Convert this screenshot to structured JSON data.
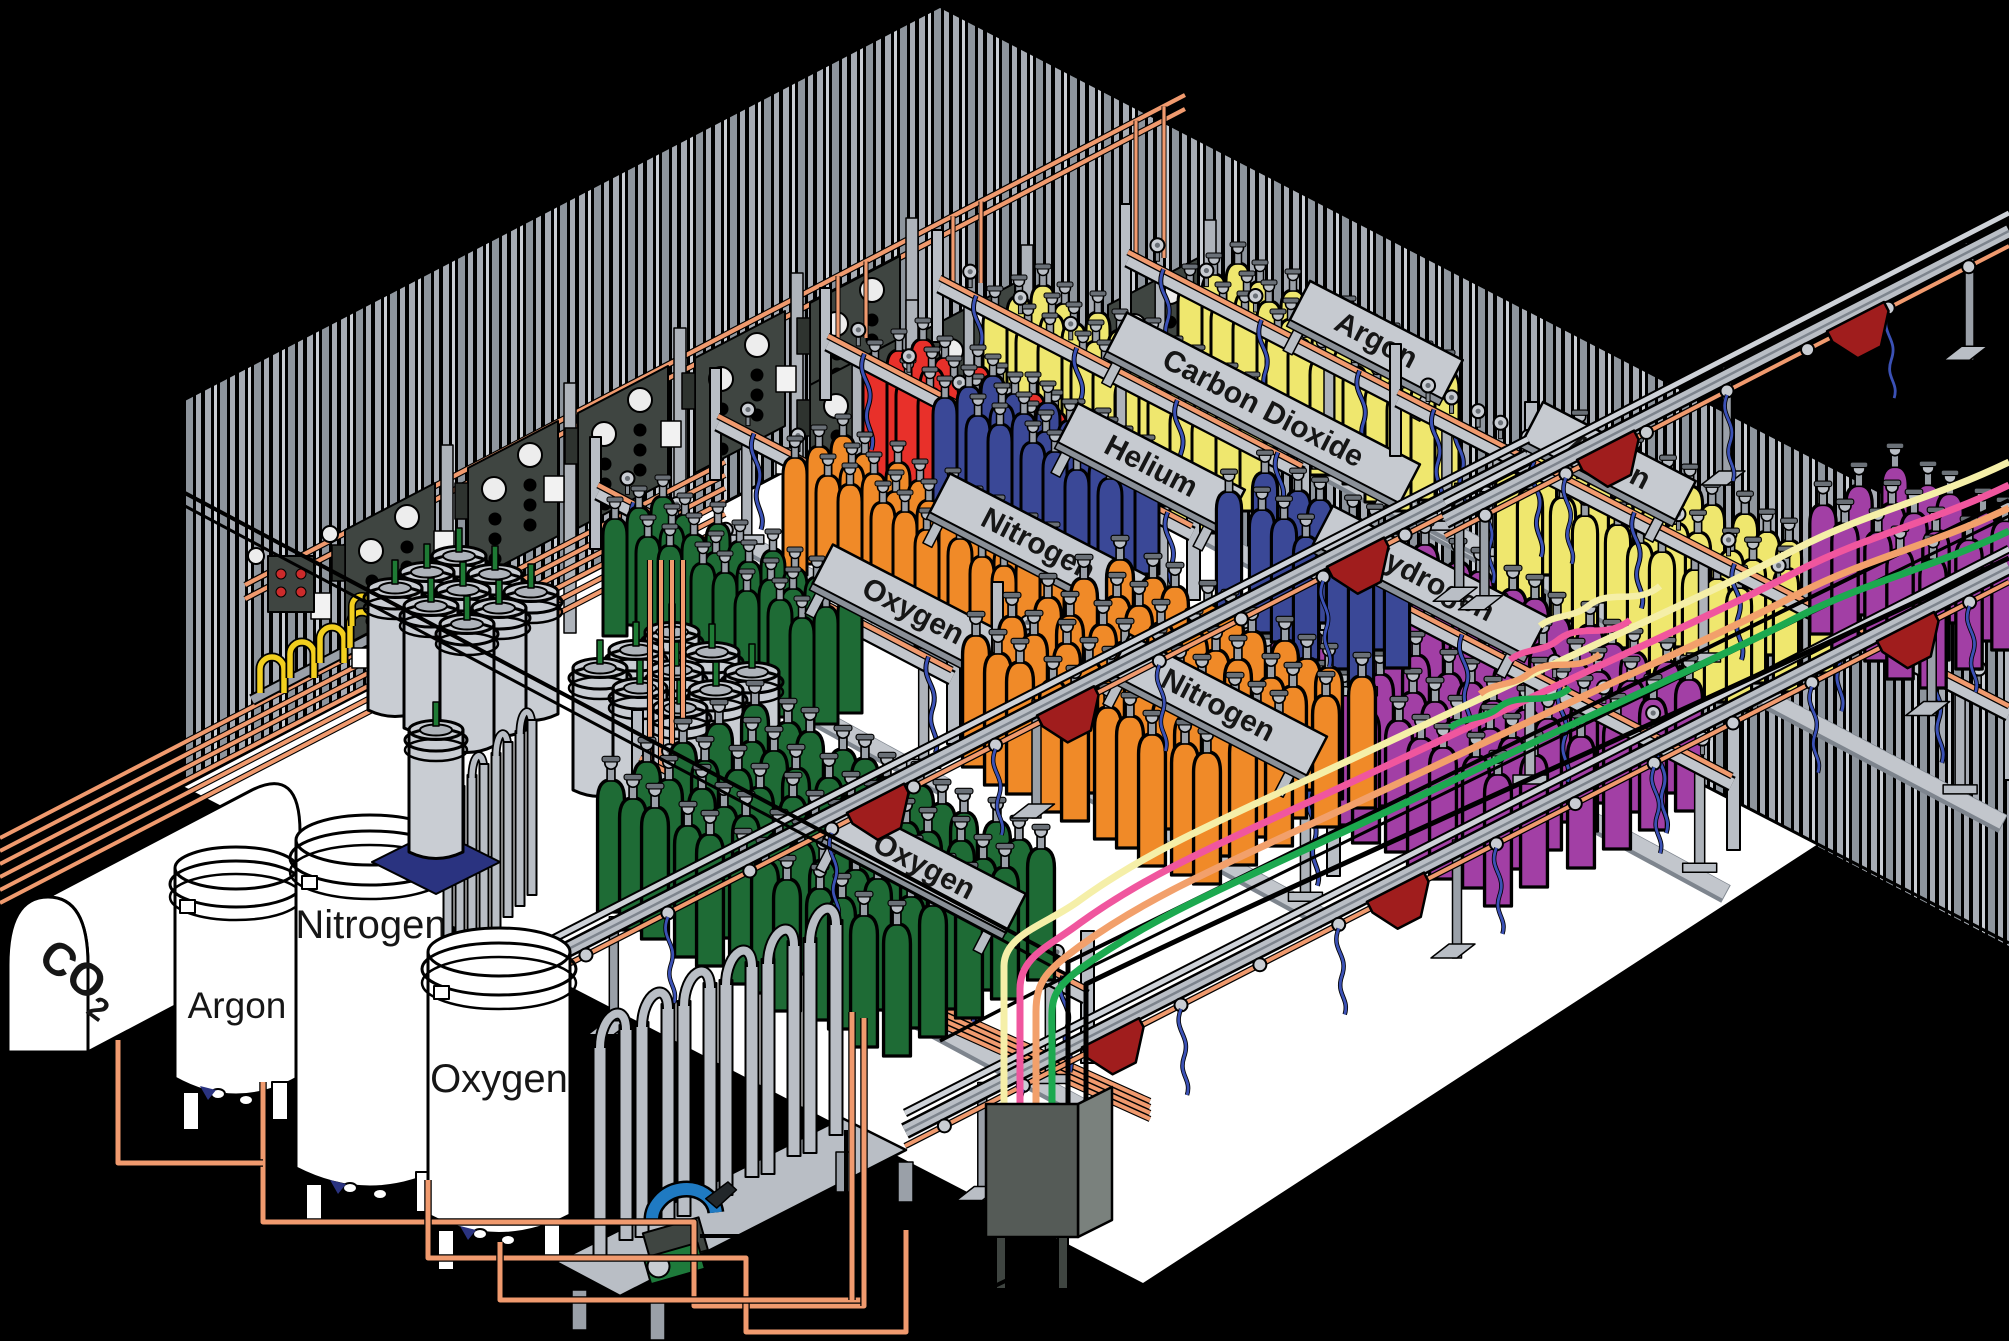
{
  "tanks": {
    "co2": "CO",
    "co2_sub": "2",
    "argon": "Argon",
    "nitrogen": "Nitrogen",
    "oxygen": "Oxygen"
  },
  "signs": {
    "oxygen_back": "Oxygen",
    "nitrogen_back": "Nitrogen",
    "helium": "Helium",
    "carbon_dioxide": "Carbon Dioxide",
    "argon_back": "Argon",
    "argon_right": "Argon",
    "hydrogen": "Hydrogen",
    "nitrogen_front": "Nitrogen",
    "oxygen_front": "Oxygen"
  },
  "colors": {
    "floor": "#FFFFFF",
    "background": "#000000",
    "copper": "#F09A6E",
    "sign_gray": "#C6CAD0",
    "panel_dark": "#3F4541",
    "trolley_red": "#A01D1D",
    "hose_blue": "#3B51B5",
    "hose_yellow": "#F2CF1E",
    "oxygen_green": "#1E6B35",
    "orange": "#F08A28",
    "nitrogen_blue": "#3A4897",
    "helium_red": "#E8302A",
    "yellow": "#EFE76E",
    "hydrogen_purple": "#A23FA5",
    "dewar_gray": "#C9CDD3",
    "line_cream": "#F5EFA8",
    "line_pink": "#F0569E",
    "line_orange": "#F2A06B",
    "line_green": "#1CA94F",
    "pallet_blue": "#2A3380",
    "pump_green": "#1E7A3B",
    "pump_blue": "#1F7AC2"
  }
}
